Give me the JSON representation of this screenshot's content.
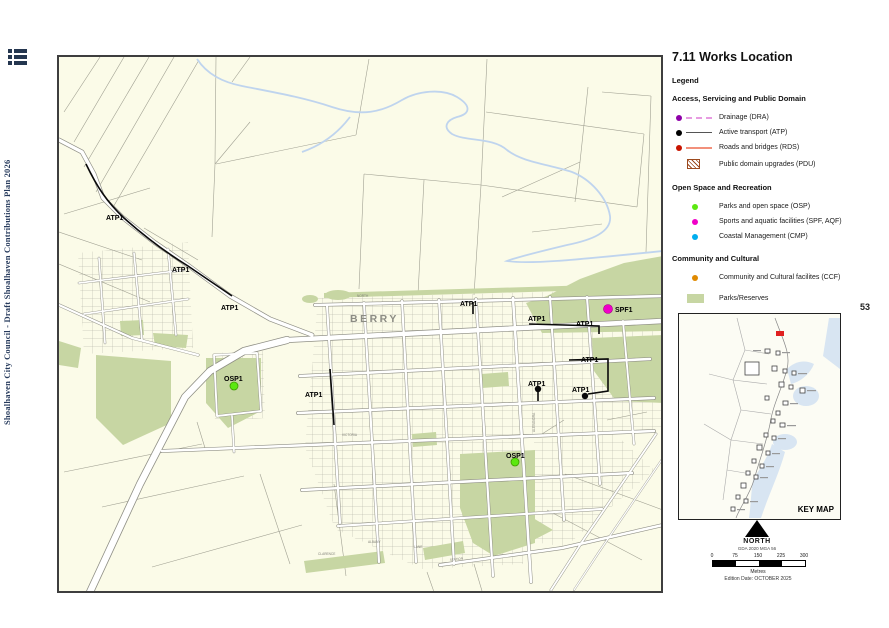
{
  "page": {
    "number": "53"
  },
  "sidebar": {
    "menu_icon": "list-menu-icon",
    "spine_text": "Shoalhaven City Council - Draft Shoalhaven Contributions Plan 2026"
  },
  "header": {
    "title": "7.11 Works Location"
  },
  "legend": {
    "heading": "Legend",
    "sections": [
      {
        "title": "Access, Servicing and Public Domain",
        "items": [
          {
            "label": "Drainage (DRA)",
            "symbol": "dot-line",
            "dot_color": "#8E00A8",
            "line_color": "#E79BE1"
          },
          {
            "label": "Active transport (ATP)",
            "symbol": "dot-line",
            "dot_color": "#000000",
            "line_color": "#555555"
          },
          {
            "label": "Roads and bridges (RDS)",
            "symbol": "dot-line",
            "dot_color": "#C81400",
            "line_color": "#F2907B"
          },
          {
            "label": "Public domain upgrades (PDU)",
            "symbol": "hatched-box",
            "hatch_color": "#9C4A1E"
          }
        ]
      },
      {
        "title": "Open Space and Recreation",
        "items": [
          {
            "label": "Parks and open space (OSP)",
            "symbol": "dot",
            "dot_color": "#5CE810"
          },
          {
            "label": "Sports and aquatic facilities (SPF, AQF)",
            "symbol": "dot",
            "dot_color": "#F000C8"
          },
          {
            "label": "Coastal Management (CMP)",
            "symbol": "dot",
            "dot_color": "#00AEEF"
          }
        ]
      },
      {
        "title": "Community and Cultural",
        "items": [
          {
            "label": "Community and Cultural facilites (CCF)",
            "symbol": "dot",
            "dot_color": "#E08A00"
          },
          {
            "label": "Parks/Reserves",
            "symbol": "area",
            "fill_color": "#C7D6A3"
          }
        ]
      }
    ]
  },
  "map": {
    "town_label": "BERRY",
    "marker_labels": {
      "atp": "ATP1",
      "osp": "OSP1",
      "spf": "SPF1"
    },
    "street_labels": [
      "NORTH",
      "VICTORIA",
      "CLARENCE",
      "ALBANY",
      "LANE",
      "STATION",
      "ALEXANDRA"
    ],
    "colors": {
      "background": "#FBFBE8",
      "parks": "#C7D6A3",
      "water": "#BFD4EE",
      "road_fill": "#FFFFFF",
      "road_casing": "#8F8F85",
      "parcel_line": "#A0A092",
      "route": "#0A0A0A"
    }
  },
  "key_map": {
    "label": "KEY MAP",
    "highlight_color": "#E02020"
  },
  "north": {
    "label": "NORTH",
    "datum": "GDA 2020 MGA 56"
  },
  "scale_bar": {
    "ticks": [
      "0",
      "75",
      "150",
      "225",
      "300"
    ],
    "unit": "Metres",
    "edition": "Edition Date: OCTOBER 2025"
  }
}
